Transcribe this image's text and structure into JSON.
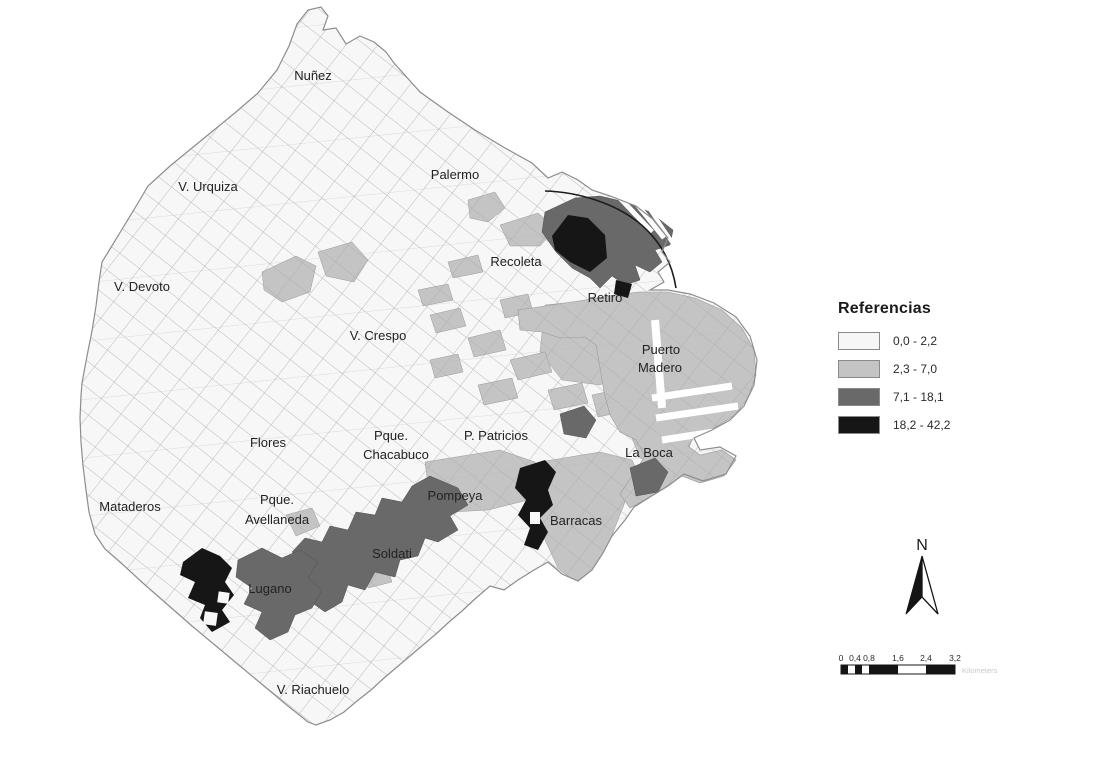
{
  "figure": {
    "type": "choropleth-map",
    "city": "Buenos Aires"
  },
  "colors": {
    "base": "#f7f7f7",
    "light": "#c4c4c4",
    "dark": "#696969",
    "black": "#161616",
    "outline": "#8d8d8d",
    "mesh": "#ababab",
    "water_line": "#1c1c1c"
  },
  "map": {
    "region_labels": [
      {
        "text": "Nuñez"
      },
      {
        "text": "Palermo"
      },
      {
        "text": "V. Urquiza"
      },
      {
        "text": "V. Devoto"
      },
      {
        "text": "Recoleta"
      },
      {
        "text": "Retiro"
      },
      {
        "text": "V. Crespo"
      },
      {
        "text": "Puerto"
      },
      {
        "text": "Madero"
      },
      {
        "text": "Flores"
      },
      {
        "text": "Pque."
      },
      {
        "text": "Chacabuco"
      },
      {
        "text": "P. Patricios"
      },
      {
        "text": "La Boca"
      },
      {
        "text": "Mataderos"
      },
      {
        "text": "Pque."
      },
      {
        "text": "Avellaneda"
      },
      {
        "text": "Pompeya"
      },
      {
        "text": "Barracas"
      },
      {
        "text": "Soldati"
      },
      {
        "text": "Lugano"
      },
      {
        "text": "V. Riachuelo"
      }
    ]
  },
  "legend": {
    "title": "Referencias",
    "items": [
      {
        "label": "0,0 - 2,2",
        "color": "#f6f6f6"
      },
      {
        "label": "2,3 - 7,0",
        "color": "#c4c4c4"
      },
      {
        "label": "7,1 - 18,1",
        "color": "#696969"
      },
      {
        "label": "18,2 - 42,2",
        "color": "#161616"
      }
    ]
  },
  "north_arrow": {
    "label": "N"
  },
  "scale_bar": {
    "tick_labels": [
      "0",
      "0,4",
      "0,8",
      "1,6",
      "2,4",
      "3,2"
    ],
    "unit_label": "Kilometers"
  }
}
